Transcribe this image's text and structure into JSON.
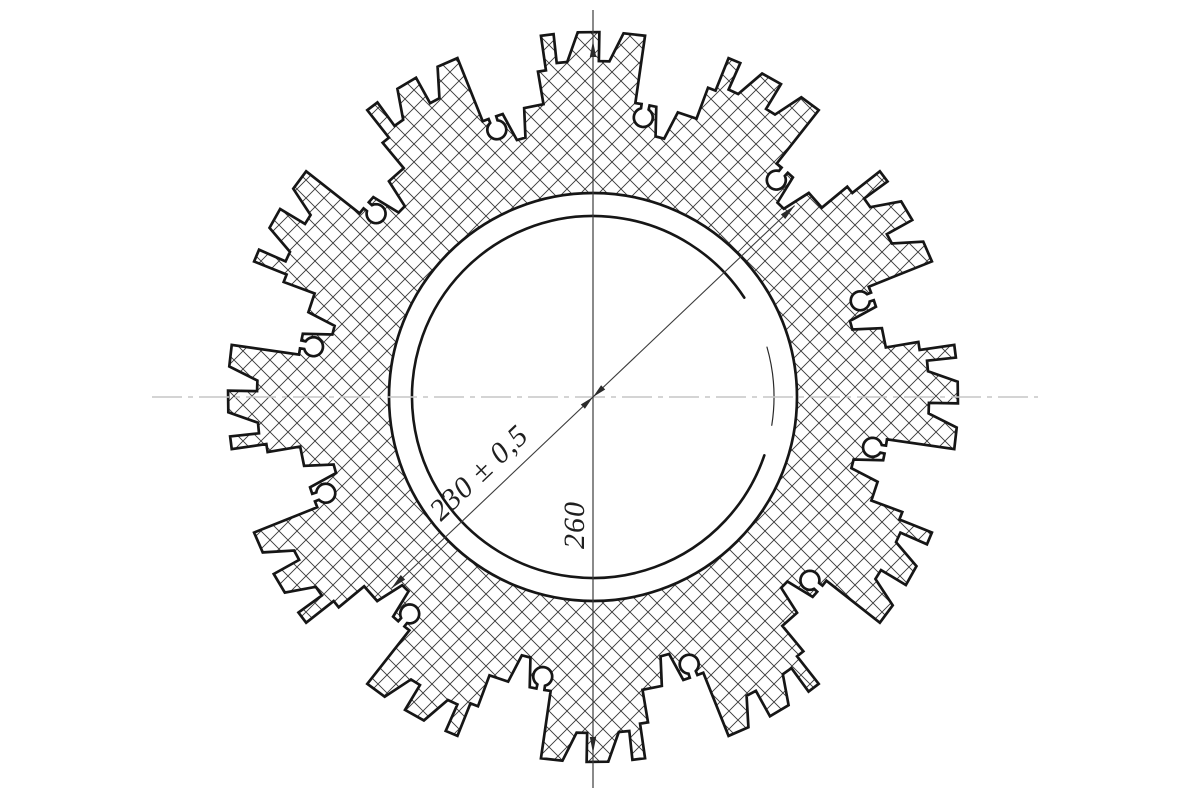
{
  "drawing": {
    "type": "engineering-cross-section",
    "labels": {
      "diagonal_dimension": "230 ± 0,5",
      "vertical_dimension": "260"
    },
    "colors": {
      "background": "#ffffff",
      "outline": "#161616",
      "hatch": "#3a3a3a",
      "dimension": "#3c3c3c",
      "centerline": "#c6c6c6",
      "text": "#1f1f1f"
    },
    "geometry": {
      "center": {
        "x": 593,
        "y": 397
      },
      "teeth": 12,
      "period_deg": 30,
      "tip_radius": 365,
      "slot_bottom_radius": 336,
      "ledge_radius": 330,
      "ledge_start_deg": 9.6,
      "valley_radius": 297,
      "tooth_half_deg": 8.2,
      "slots": [
        {
          "open": [
            -6.2,
            -2.4
          ],
          "bottom": [
            -6.2,
            -4.4
          ]
        },
        {
          "open": [
            1.0,
            4.8
          ],
          "bottom": [
            1.0,
            2.8
          ]
        }
      ],
      "keyhole": {
        "angle_deg": 10.2,
        "center_radius": 284,
        "radius": 9.5,
        "neck_half_deg": 0.78
      },
      "notch": {
        "open": [
          12.3,
          16.6
        ],
        "bottom": [
          13.5,
          15.4
        ],
        "bottom_radius": 268
      },
      "inner_bore_radius": 204,
      "circle230": {
        "radius": 181,
        "main_arc_screen_deg": [
          -33.3,
          18.8
        ],
        "thin_arc_screen_deg": [
          -16,
          9
        ]
      },
      "hatch_tile": 18,
      "centerline_h": {
        "x1": 152,
        "x2": 1038,
        "y": 397
      },
      "centerline_v": {
        "x": 593,
        "y1": 10,
        "y2": 788
      },
      "dim_vertical": {
        "arrow_top_y": 41,
        "arrow_bottom_y": 753
      },
      "dim_diagonal": {
        "angle_deg": 46.5,
        "tip_radius": 278,
        "center_arrows": true
      }
    }
  }
}
